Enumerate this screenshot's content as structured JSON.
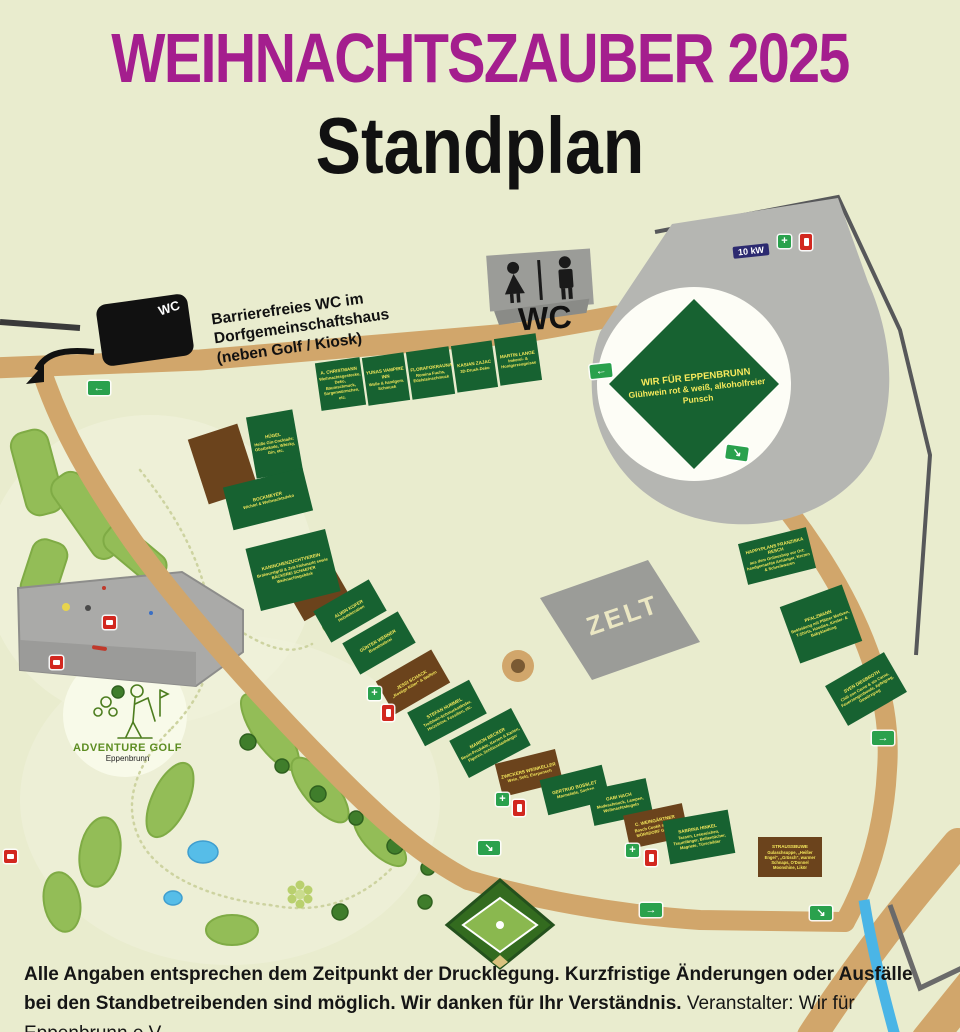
{
  "title": "WEIHNACHTSZAUBER 2025",
  "subtitle": "Standplan",
  "wc_note": {
    "line1": "Barrierefreies WC im",
    "line2": "Dorfgemeinschaftshaus",
    "line3": "(neben Golf / Kiosk)",
    "sign": "WC"
  },
  "wc_label": "WC",
  "zelt_label": "ZELT",
  "power_badge": "10 kW",
  "main_stand": {
    "name": "WIR FÜR EPPENBRUNN",
    "desc": "Glühwein rot & weiß, alkoholfreier Punsch"
  },
  "stands": [
    {
      "name": "A. CHRISTMANN",
      "desc": "Weihnachtsgestecke, Deko, Baumschmuck, Sorgenwürmchen, etc."
    },
    {
      "name": "YUNAS VAMPIRE INN",
      "desc": "Wolle & handgem. Schmuck"
    },
    {
      "name": "FLORAFOKRAUNA",
      "desc": "Romina Fuchs, Edelsteinschmuck"
    },
    {
      "name": "KASIAN ZAJAC",
      "desc": "3D-Druck-Deko"
    },
    {
      "name": "MARTIN LANGE",
      "desc": "Imkerei- & Honigerzeugnisse"
    },
    {
      "name": "HÜGEL",
      "desc": "Heiße Gin-Cocktails: Obstbrände, Whisky, Gin, etc."
    },
    {
      "name": "BOCKMEYER",
      "desc": "Wichtel & Weihnachtsdeko"
    },
    {
      "name": "KANINCHENZUCHTVEREIN",
      "desc": "Bratwurstgrill & Zelt-Flohmarkt sowie BÄCKEREI SCHAEFER Weihnachtsgebäck"
    },
    {
      "name": "ALWIN KOFER",
      "desc": "Holzdekoration"
    },
    {
      "name": "GÜNTER WERNER",
      "desc": "Brandmalerei"
    },
    {
      "name": "JESSI SCHACK",
      "desc": "„Rostige Ritter“ & Waffeln"
    },
    {
      "name": "STEFAN HUMMEL",
      "desc": "Treibholz-Schmuckständer, Heizsteine, Fossilien, etc."
    },
    {
      "name": "MARION BECKER",
      "desc": "Resin-Produkte, Kerzen & Karten, Figuren, Schlüsselanhänger"
    },
    {
      "name": "ZWICKERS WEINKELLER",
      "desc": "Wein, Sekt, Eierpunsch"
    },
    {
      "name": "GERTRUD BOSSLET",
      "desc": "Marmelade, Socken"
    },
    {
      "name": "GABI HACH",
      "desc": "Modeschmuck, Lampen, Weihnachtskugeln"
    },
    {
      "name": "C. WEINGÄRTNER",
      "desc": "Bosch Cookit sowie S. MÖRSDORF Gewürze"
    },
    {
      "name": "SABRINA HINKEL",
      "desc": "Tassen, Lesezeichen, Traumfänger, Brillentücher, Magnete, Türschilder"
    },
    {
      "name": "STRAUSSBUWE",
      "desc": "Gulaschsuppe, „Heißer Engel“, „Grüsch“, warmer Schnaps, O'Donnel Moonshine, Likör"
    },
    {
      "name": "HAPPYPLANS FRANZISKA RESCH",
      "desc": "aus dem Onlineshop vor Ort: handgemachte Anhänger, Kerzen & Schreibwaren"
    },
    {
      "name": "PFALZMANN",
      "desc": "Bekleidung mit Pfälzer Motiven, T-Shirts, Hoodies, Kinder- & Babykleidung"
    },
    {
      "name": "SVEN DIESBROTH",
      "desc": "Chili con Carne & sin Carne, Feuerzangenbowle, Apfelgrog, Gewürzgrog"
    }
  ],
  "golf_logo": {
    "line1": "ADVENTURE GOLF",
    "line2": "Eppenbrunn"
  },
  "footer": {
    "line1": "Alle Angaben entsprechen dem Zeitpunkt der Drucklegung. Kurzfristige Änderungen oder Ausfälle",
    "line2_bold": "bei den Standbetreibenden sind möglich. Wir danken für Ihr Verständnis. ",
    "line2_regular": "Veranstalter: Wir für Eppenbrunn e.V."
  },
  "icons": {
    "arrow_left": "←",
    "arrow_right": "→",
    "arrow_down_right": "↘",
    "cross": "+"
  },
  "colors": {
    "title": "#a41e8e",
    "background": "#e9ecce",
    "road": "#d1a66b",
    "stand_green": "#176231",
    "stand_brown": "#6b431c",
    "stand_text": "#f6e95c",
    "parking_gray": "#b5b6b2",
    "exit_green": "#2aa14d",
    "safety_red": "#d2271f",
    "river_blue": "#4ab5e6"
  }
}
